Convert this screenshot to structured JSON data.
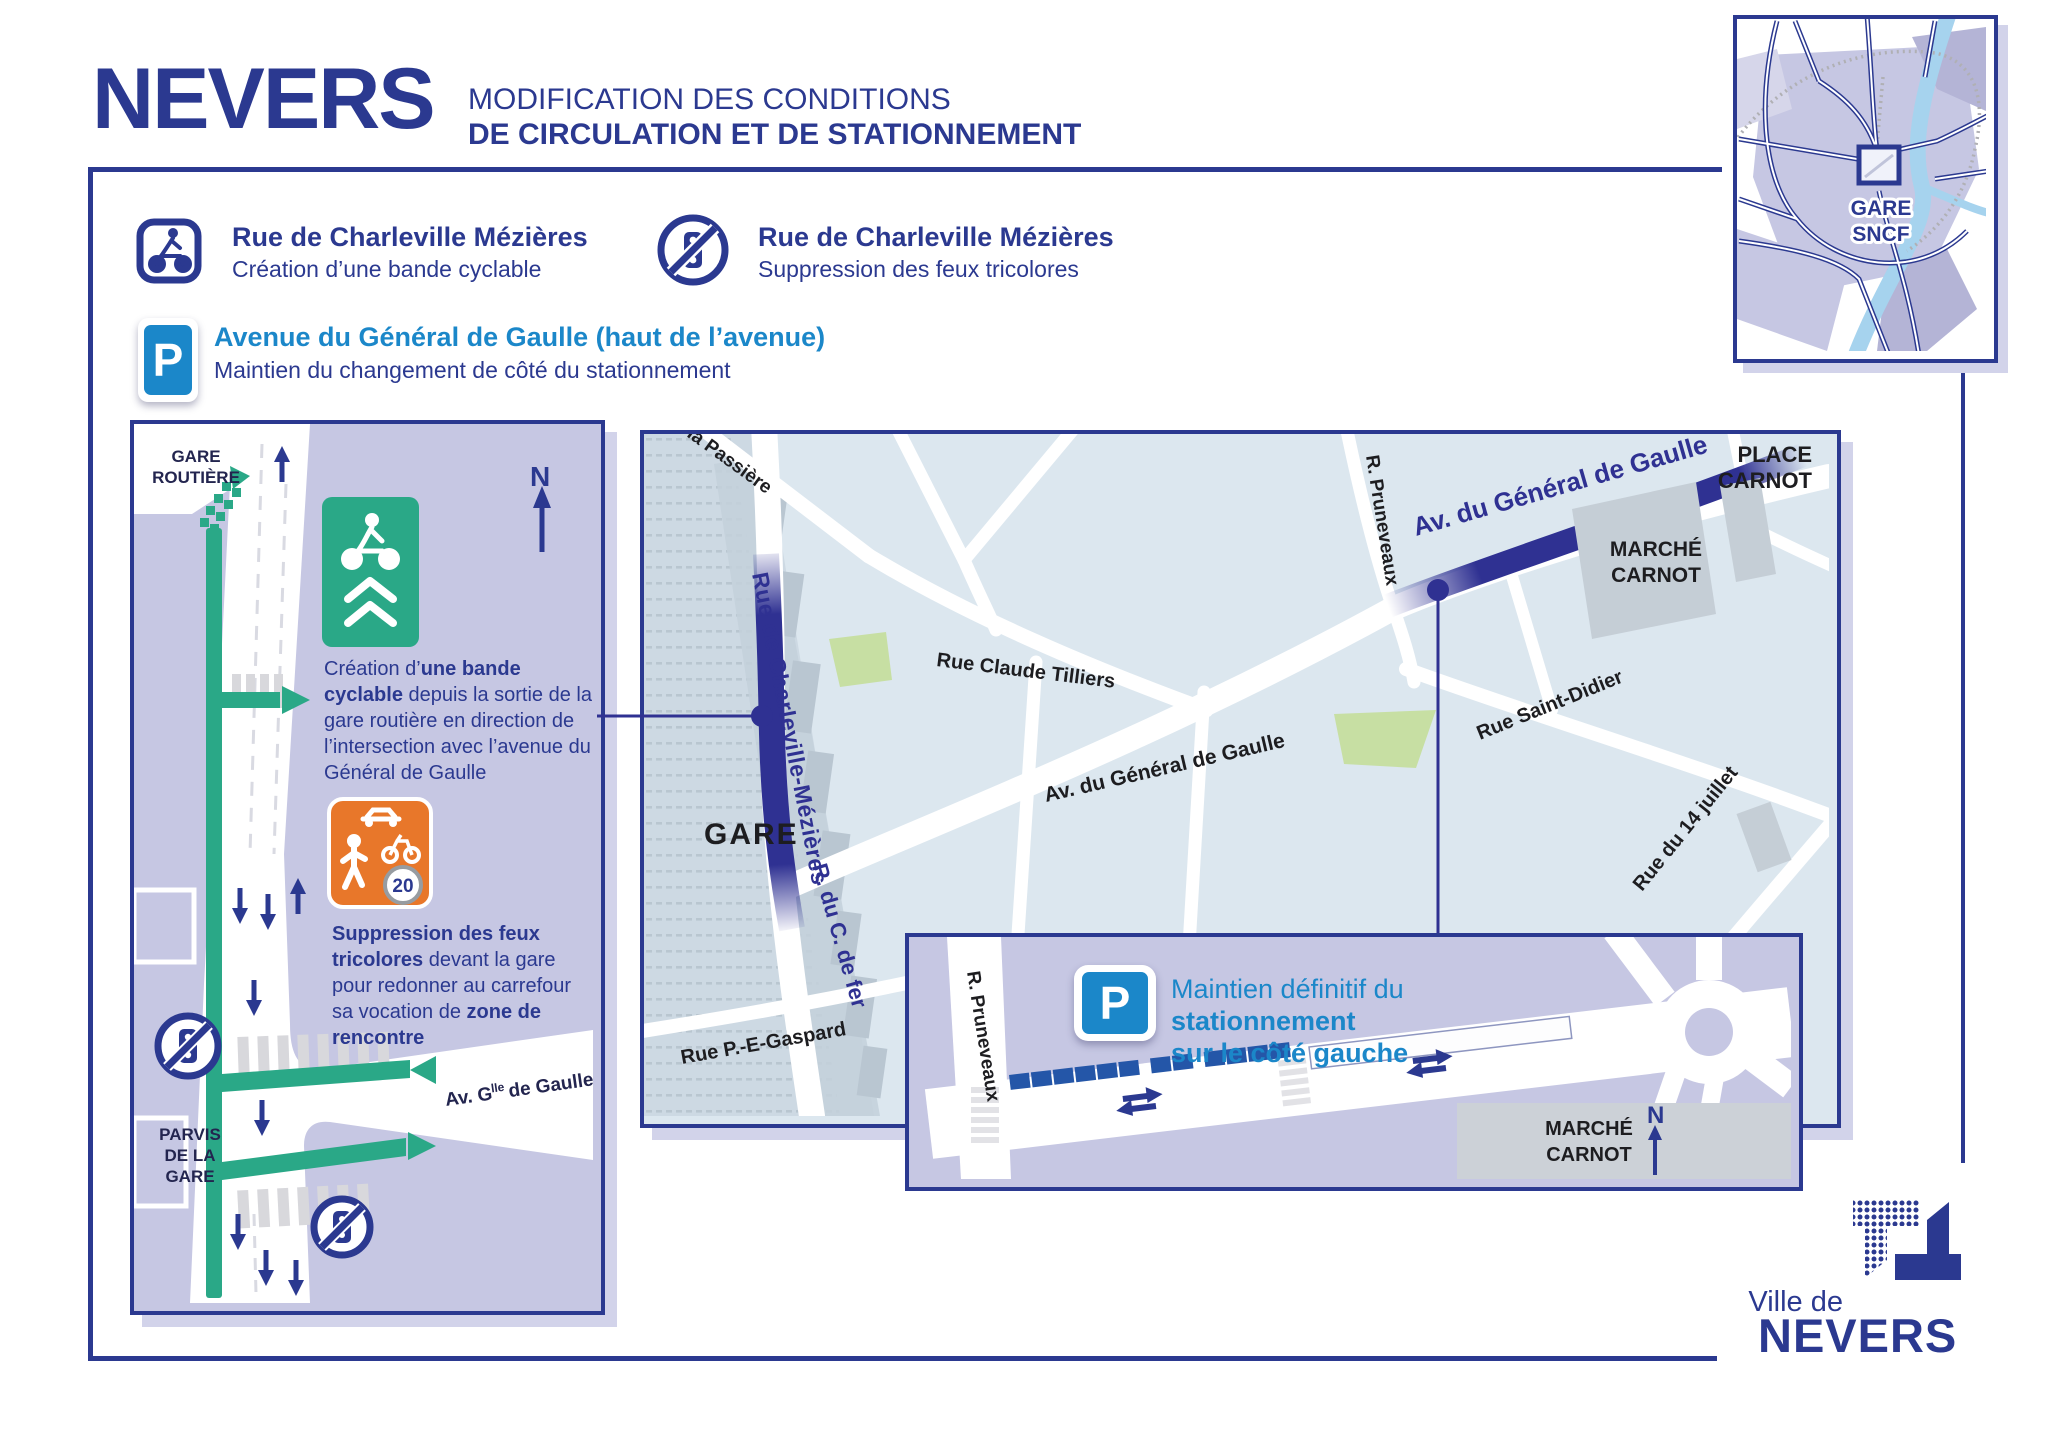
{
  "header": {
    "logo": "NEVERS",
    "title_line1": "MODIFICATION DES CONDITIONS",
    "title_line2": "DE CIRCULATION ET DE STATIONNEMENT"
  },
  "legend": {
    "cyclable": {
      "title": "Rue de Charleville Mézières",
      "subtitle": "Création d’une bande cyclable"
    },
    "feux": {
      "title": "Rue de Charleville Mézières",
      "subtitle": "Suppression des feux tricolores"
    },
    "parking": {
      "icon": "P",
      "title": "Avenue du Général de Gaulle (haut de l’avenue)",
      "subtitle": "Maintien du changement de côté du stationnement"
    }
  },
  "overview_inset": {
    "gare_line1": "GARE",
    "gare_line2": "SNCF"
  },
  "left_panel": {
    "gare_routiere_1": "GARE",
    "gare_routiere_2": "ROUTIÈRE",
    "north": "N",
    "note_cyclable": {
      "pre": "Création d’",
      "bold": "une bande cyclable",
      "post": " depuis la sortie de la gare routière en direction de l’intersection avec l’avenue du Général de Gaulle"
    },
    "sign_20": "20",
    "note_feux": {
      "bold1": "Suppression des feux tricolores",
      "mid": " devant la gare pour redonner au carrefour sa vocation de ",
      "bold2": "zone de rencontre"
    },
    "parvis_1": "PARVIS",
    "parvis_2": "DE LA",
    "parvis_3": "GARE",
    "avenue": {
      "pre": "Av. G",
      "sup": "lle",
      "post": " de Gaulle"
    }
  },
  "map": {
    "streets": {
      "passiere": "la Passière",
      "charleville": "Rue de Charleville-Mézières",
      "tilliers": "Rue Claude Tilliers",
      "gaulle": "Av. du Général de Gaulle",
      "gaulle_highlight": "Av. du Général de Gaulle",
      "pruneveaux": "R. Pruneveaux",
      "saint_didier": "Rue Saint-Didier",
      "quatorze_juillet": "Rue du 14 juillet",
      "chemin_de_fer": "R. du C. de fer",
      "gaspard": "Rue P.-E-Gaspard"
    },
    "gare": "GARE",
    "place_carnot_1": "PLACE",
    "place_carnot_2": "CARNOT",
    "marche_1": "MARCHÉ",
    "marche_2": "CARNOT"
  },
  "parking_inset": {
    "icon": "P",
    "text_pre": "Maintien définitif du ",
    "text_bold": "stationnement",
    "text_line2": "sur le côté gauche",
    "pruneveaux": "R. Pruneveaux",
    "marche_1": "MARCHÉ",
    "marche_2": "CARNOT",
    "north": "N"
  },
  "footer": {
    "ville_de": "Ville de",
    "nevers": "NEVERS"
  },
  "colors": {
    "navy": "#2b3990",
    "highlight": "#2f3192",
    "light_blue": "#1b87c9",
    "teal": "#2aa887",
    "orange": "#e8772a",
    "lavender": "#c6c7e3",
    "map_bg": "#dce7ef",
    "parking_blue": "#2456a8",
    "park_green": "#c7dfa3"
  }
}
